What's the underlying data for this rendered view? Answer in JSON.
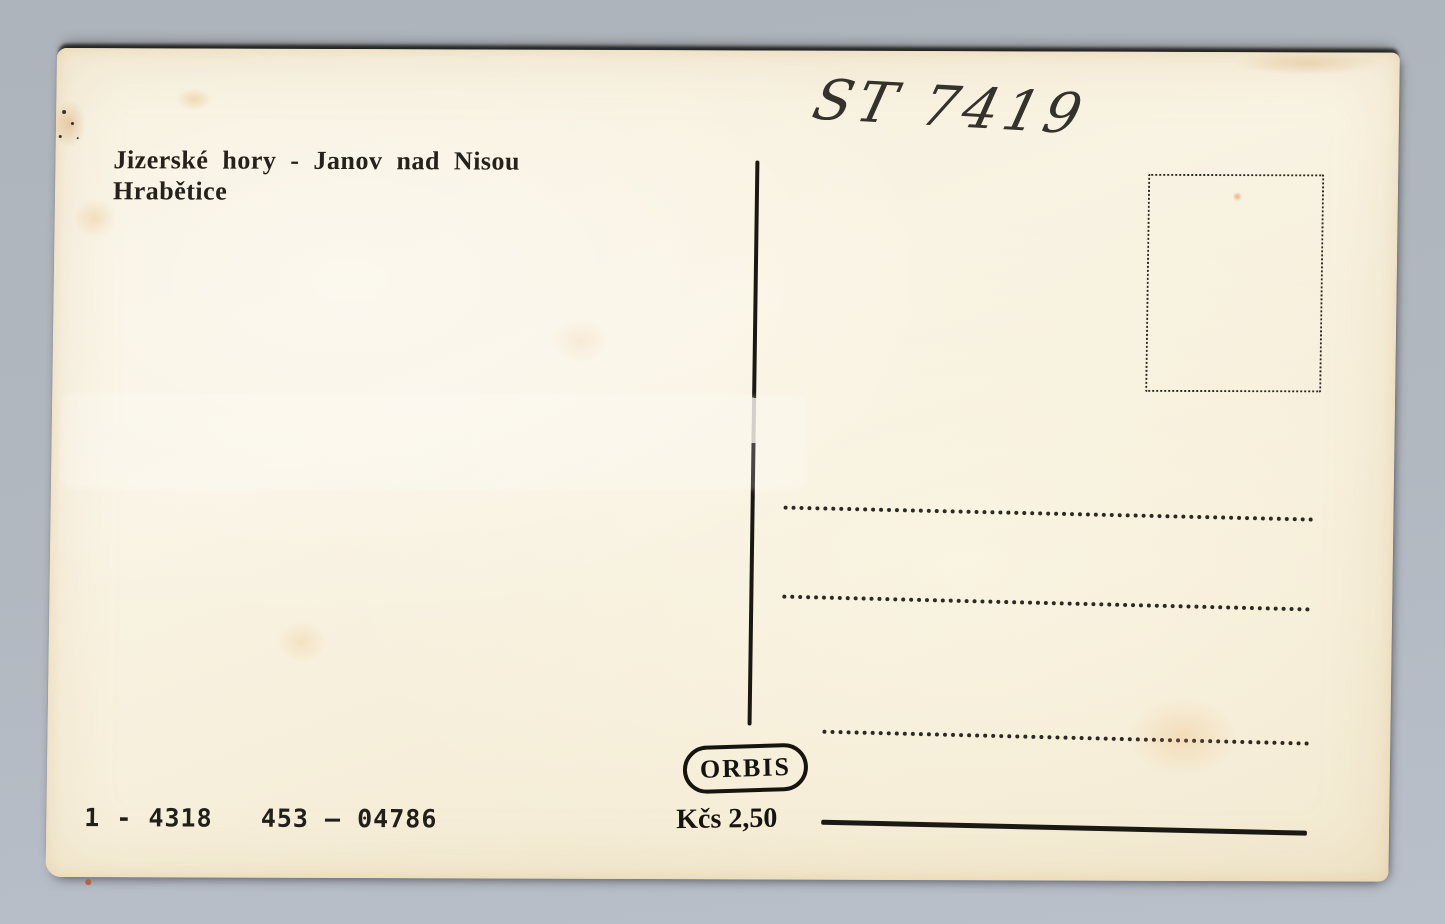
{
  "scan": {
    "background_color": "#b2b8c0",
    "paper_color": "#f7f0dc",
    "ink_color": "#1d1a15",
    "stain_color": "#d99a4e"
  },
  "postcard": {
    "caption": {
      "line1": "Jizerské hory - Janov nad Nisou",
      "line2": "Hrabětice"
    },
    "handwritten_note": "ST 7419",
    "publisher_mark": "ORBIS",
    "price": "Kčs 2,50",
    "print_code": "1 - 4318   453 – 04786"
  }
}
